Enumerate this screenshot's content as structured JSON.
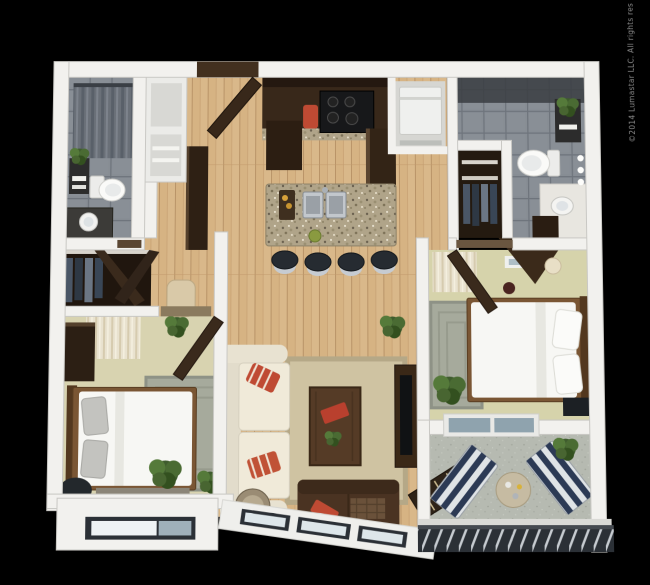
{
  "watermark": "©2014 Lumastar LLC. All rights reserved.",
  "scene": {
    "type": "3d-floorplan-render",
    "view": "top-down",
    "rooms": [
      "bathroom-1",
      "closet-niches",
      "entry",
      "kitchen",
      "laundry-nook",
      "bathroom-2",
      "walk-in-closet",
      "bedroom-1",
      "living-room",
      "bedroom-2",
      "balcony"
    ]
  },
  "colors": {
    "background": "#000000",
    "wall": "#f2f1ee",
    "wood_floor": "#d9b88a",
    "tile": "#878d94",
    "carpet_1": "#d8d3b0",
    "carpet_2": "#d6d3ab",
    "concrete": "#b6bab1",
    "granite": "#b0a489",
    "espresso": "#38281a",
    "sofa_cream": "#f0ead9",
    "rug_living": "#cfc3a2",
    "rug_gray": "#a6aa9c",
    "bedding": "#f7f7f4",
    "accent_red": "#bf4a33",
    "stripe_navy": "#2c3a55",
    "plant_green": "#4a6b33",
    "railing": "#2b3036",
    "glass": "#8fa3ae"
  }
}
